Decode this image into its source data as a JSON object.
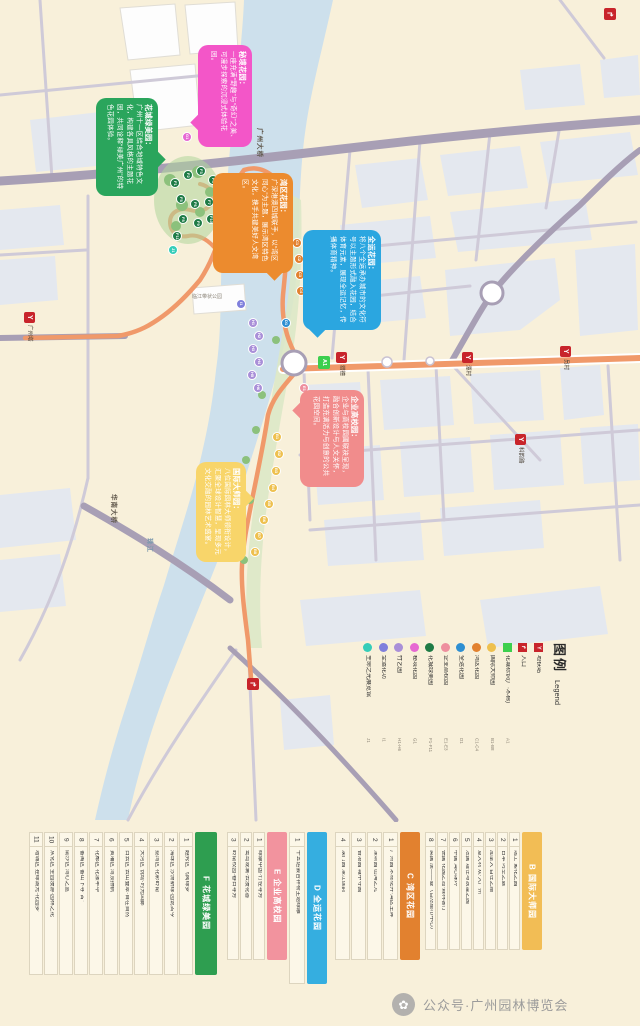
{
  "page": {
    "background": "#f8f0da"
  },
  "icons": {
    "metro_glyph": "Y",
    "entrance_glyph": "↱",
    "footer_flower": "✿"
  },
  "map": {
    "callouts": [
      {
        "id": "mystic",
        "color": "#f356c8",
        "title": "秘境花园：",
        "body": "一座充满“野趣”与“奇幻”之美、可漫步探索的沉浸式体验花园。"
      },
      {
        "id": "greenbeauty",
        "color": "#2aa55c",
        "title": "花城绿美园：",
        "body": "广州十一区结合地域特色文化，构建各具风格的主题花园，共同诠释“绿美广州”的特色花园体验。"
      },
      {
        "id": "bay",
        "color": "#ec8b2e",
        "title": "湾区花园：",
        "body": "广深港澳四城联手，以“湾区同心”为主题，展示湾区特色文化，携手共建美好人文湾区。"
      },
      {
        "id": "games",
        "color": "#2ba6e0",
        "title": "全运花园：",
        "body": "将八个全运承办城市的文化符号以主题形式融入花园，结合体育元素，展现全运记忆，传播体育精神。"
      },
      {
        "id": "enterprise",
        "color": "#f18c8c",
        "title": "企业高校园：",
        "body": "企业与高校园圃联袂呈现，融合创新设计与人文关怀，打造充满活力与创意的公共花园空间。"
      },
      {
        "id": "master",
        "color": "#f8d56a",
        "title": "国际大师园：",
        "body": "八位国际园林大师领衔设计，汇聚全球设计智慧，呈现多元文化交融的园林艺术盛宴。"
      }
    ],
    "labels": [
      {
        "text": "广州大桥",
        "x": 256,
        "y": 128,
        "cls": "road"
      },
      {
        "text": "珠江",
        "x": 146,
        "y": 538,
        "cls": "water"
      },
      {
        "text": "华南大桥",
        "x": 110,
        "y": 494,
        "cls": "road"
      },
      {
        "text": "临江带状公园",
        "x": 192,
        "y": 293,
        "cls": "horiz"
      }
    ],
    "stations": [
      {
        "name": "五羊邨",
        "x": 278,
        "y": 200
      },
      {
        "name": "广州塔",
        "x": 24,
        "y": 312
      },
      {
        "name": "猎德",
        "x": 336,
        "y": 352
      },
      {
        "name": "潭村",
        "x": 462,
        "y": 352
      },
      {
        "name": "员村",
        "x": 560,
        "y": 346
      },
      {
        "name": "科韵路",
        "x": 515,
        "y": 434
      }
    ],
    "entrances": [
      {
        "x": 247,
        "y": 678
      },
      {
        "x": 604,
        "y": 8
      }
    ],
    "a1": {
      "code": "A1",
      "color": "#3ccf4e",
      "x": 318,
      "y": 356
    },
    "markers": [
      {
        "code": "F1",
        "color": "#1e7b46",
        "x": 170,
        "y": 178
      },
      {
        "code": "F2",
        "color": "#1e7b46",
        "x": 183,
        "y": 170
      },
      {
        "code": "F3",
        "color": "#1e7b46",
        "x": 196,
        "y": 166
      },
      {
        "code": "F4",
        "color": "#1e7b46",
        "x": 208,
        "y": 175
      },
      {
        "code": "F5",
        "color": "#1e7b46",
        "x": 176,
        "y": 194
      },
      {
        "code": "F6",
        "color": "#1e7b46",
        "x": 190,
        "y": 199
      },
      {
        "code": "F7",
        "color": "#1e7b46",
        "x": 204,
        "y": 197
      },
      {
        "code": "F8",
        "color": "#1e7b46",
        "x": 178,
        "y": 214
      },
      {
        "code": "F9",
        "color": "#1e7b46",
        "x": 193,
        "y": 218
      },
      {
        "code": "F10",
        "color": "#1e7b46",
        "x": 206,
        "y": 214
      },
      {
        "code": "F11",
        "color": "#1e7b46",
        "x": 172,
        "y": 231
      },
      {
        "code": "G1",
        "color": "#e668d2",
        "x": 182,
        "y": 132
      },
      {
        "code": "J1",
        "color": "#35cdb9",
        "x": 168,
        "y": 245
      },
      {
        "code": "I1",
        "color": "#8080dc",
        "x": 236,
        "y": 299
      },
      {
        "code": "D1",
        "color": "#2e8fd2",
        "x": 281,
        "y": 318
      },
      {
        "code": "C1",
        "color": "#e2812f",
        "x": 292,
        "y": 238
      },
      {
        "code": "C2",
        "color": "#e2812f",
        "x": 294,
        "y": 254
      },
      {
        "code": "C3",
        "color": "#e2812f",
        "x": 295,
        "y": 270
      },
      {
        "code": "C4",
        "color": "#e2812f",
        "x": 296,
        "y": 286
      },
      {
        "code": "E1",
        "color": "#ee8f9e",
        "x": 299,
        "y": 383
      },
      {
        "code": "E2",
        "color": "#ee8f9e",
        "x": 305,
        "y": 396
      },
      {
        "code": "E3",
        "color": "#ee8f9e",
        "x": 299,
        "y": 409
      },
      {
        "code": "H1",
        "color": "#a98fd8",
        "x": 248,
        "y": 318
      },
      {
        "code": "H2",
        "color": "#a98fd8",
        "x": 254,
        "y": 331
      },
      {
        "code": "H3",
        "color": "#a98fd8",
        "x": 248,
        "y": 344
      },
      {
        "code": "H4",
        "color": "#a98fd8",
        "x": 254,
        "y": 357
      },
      {
        "code": "H5",
        "color": "#a98fd8",
        "x": 247,
        "y": 370
      },
      {
        "code": "H6",
        "color": "#a98fd8",
        "x": 253,
        "y": 383
      },
      {
        "code": "B1",
        "color": "#eec04e",
        "x": 272,
        "y": 432
      },
      {
        "code": "B2",
        "color": "#eec04e",
        "x": 274,
        "y": 449
      },
      {
        "code": "B3",
        "color": "#eec04e",
        "x": 271,
        "y": 466
      },
      {
        "code": "B4",
        "color": "#eec04e",
        "x": 268,
        "y": 483
      },
      {
        "code": "B5",
        "color": "#eec04e",
        "x": 264,
        "y": 499
      },
      {
        "code": "B6",
        "color": "#eec04e",
        "x": 259,
        "y": 515
      },
      {
        "code": "B7",
        "color": "#eec04e",
        "x": 254,
        "y": 531
      },
      {
        "code": "B8",
        "color": "#eec04e",
        "x": 250,
        "y": 547
      }
    ]
  },
  "legend": {
    "title_zh": "图例",
    "title_en": "Legend",
    "items": [
      {
        "label": "地铁站",
        "code": "",
        "color": "#c8242b",
        "glyph": "Y"
      },
      {
        "label": "入口",
        "code": "",
        "color": "#c8242b",
        "glyph": "↱"
      },
      {
        "label": "花城标识(广·木棉)",
        "code": "A1",
        "color": "#3ccf4e",
        "glyph": ""
      },
      {
        "label": "国际大师园",
        "code": "B1-B8",
        "color": "#eec04e",
        "glyph": "",
        "cls": "is-dot"
      },
      {
        "label": "湾区花园",
        "code": "C1-C4",
        "color": "#e2812f",
        "glyph": "",
        "cls": "is-dot"
      },
      {
        "label": "全运花园",
        "code": "D1",
        "color": "#2e8fd2",
        "glyph": "",
        "cls": "is-dot"
      },
      {
        "label": "企业高校园",
        "code": "E1-E3",
        "color": "#ee8f9e",
        "glyph": "",
        "cls": "is-dot"
      },
      {
        "label": "花城绿美园",
        "code": "F1-F11",
        "color": "#1e7b46",
        "glyph": "",
        "cls": "is-dot"
      },
      {
        "label": "秘境花园",
        "code": "G1",
        "color": "#e668d2",
        "glyph": "",
        "cls": "is-dot"
      },
      {
        "label": "竹艺园",
        "code": "H1-H6",
        "color": "#a98fd8",
        "glyph": "",
        "cls": "is-dot"
      },
      {
        "label": "全运花坊",
        "code": "I1",
        "color": "#8080dc",
        "glyph": "",
        "cls": "is-dot"
      },
      {
        "label": "生命之光展览馆",
        "code": "J1",
        "color": "#35cdb9",
        "glyph": "",
        "cls": "is-dot"
      }
    ]
  },
  "tables": {
    "B": {
      "title": "B 国际大师园",
      "color": "#f2bd55",
      "rows": [
        {
          "n": "1",
          "t": "瑞士 繁花之园"
        },
        {
          "n": "2",
          "t": "日本 时空之庭"
        },
        {
          "n": "3",
          "t": "加拿大 自在之路"
        },
        {
          "n": "4",
          "t": "意大利 欢·入广州"
        },
        {
          "n": "5",
          "t": "法国 理性与浪漫之园"
        },
        {
          "n": "6",
          "t": "中国 湾心珠环"
        },
        {
          "n": "7",
          "t": "德国 花园之岛·森林客厅"
        },
        {
          "n": "8",
          "t": "英国 唐——曼（自然都市中心）"
        }
      ]
    },
    "C": {
      "title": "C 湾区花园",
      "color": "#e2812f",
      "rows": [
        {
          "n": "1",
          "t": "广州园 木棉花开·湾区生辉"
        },
        {
          "n": "2",
          "t": "深圳园 山海之光"
        },
        {
          "n": "3",
          "t": "香港园 城中寻园"
        },
        {
          "n": "4",
          "t": "澳门园 濠江莲韵"
        }
      ]
    },
    "D": {
      "title": "D 全运花园",
      "color": "#35aee0",
      "rows": [
        {
          "n": "1",
          "t": "十五运会吉祥物主题绿雕"
        }
      ]
    },
    "E": {
      "title": "E 企业高校园",
      "color": "#f2939e",
      "rows": [
        {
          "n": "1",
          "t": "绿康中国·竹径寻芳"
        },
        {
          "n": "2",
          "t": "鹭岛观澜·云漫花香"
        },
        {
          "n": "3",
          "t": "岭南校园·春日寻芳"
        }
      ]
    },
    "F": {
      "title": "F 花城绿美园",
      "color": "#2e9e50",
      "rows": [
        {
          "n": "1",
          "t": "越秀区 飞阅绿梦"
        },
        {
          "n": "2",
          "t": "海珠区 沙洲新绿·园说古今"
        },
        {
          "n": "3",
          "t": "荔湾区 花影岭南"
        },
        {
          "n": "4",
          "t": "天河区 悦动·时光回廊"
        },
        {
          "n": "5",
          "t": "白云区 云山叠翠·自在自然"
        },
        {
          "n": "6",
          "t": "黄埔区 湾顶扬帆"
        },
        {
          "n": "7",
          "t": "花都区 花漾年华"
        },
        {
          "n": "8",
          "t": "番禺区 番山下寻“古”"
        },
        {
          "n": "9",
          "t": "南沙区 湾心之蓝"
        },
        {
          "n": "10",
          "t": "从化区 全园漫游·园林之花"
        },
        {
          "n": "11",
          "t": "增城区 挂绿湖光·花园梦"
        }
      ]
    }
  },
  "footer": {
    "text": "公众号·广州园林博览会"
  }
}
